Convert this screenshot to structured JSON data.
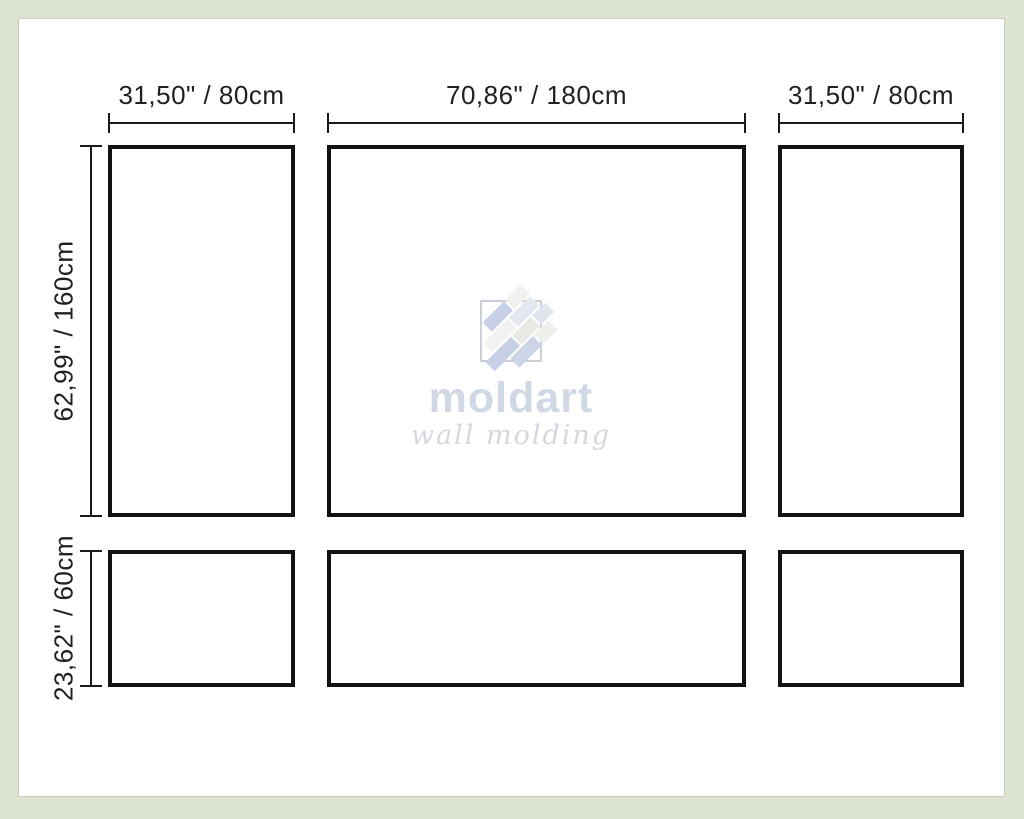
{
  "frame": {
    "color": "#dde3d1",
    "panel_border_color": "#121212",
    "dimension_line_color": "#1a1a1a"
  },
  "dimensions": {
    "top_left_width": "31,50\" / 80cm",
    "top_center_width": "70,86\" / 180cm",
    "top_right_width": "31,50\" / 80cm",
    "left_top_height": "62,99\" / 160cm",
    "left_bottom_height": "23,62\" / 60cm"
  },
  "panels": [
    {
      "row": "top",
      "position": "left",
      "width_cm": 80,
      "height_cm": 160
    },
    {
      "row": "top",
      "position": "center",
      "width_cm": 180,
      "height_cm": 160
    },
    {
      "row": "top",
      "position": "right",
      "width_cm": 80,
      "height_cm": 160
    },
    {
      "row": "bottom",
      "position": "left",
      "width_cm": 80,
      "height_cm": 60
    },
    {
      "row": "bottom",
      "position": "center",
      "width_cm": 180,
      "height_cm": 60
    },
    {
      "row": "bottom",
      "position": "right",
      "width_cm": 80,
      "height_cm": 60
    }
  ],
  "watermark": {
    "brand": "moldart",
    "tagline": "wall molding",
    "brand_color": "#d1d8e5",
    "icon_blue": "#c7d0e6",
    "icon_pale": "#eff1ee"
  }
}
